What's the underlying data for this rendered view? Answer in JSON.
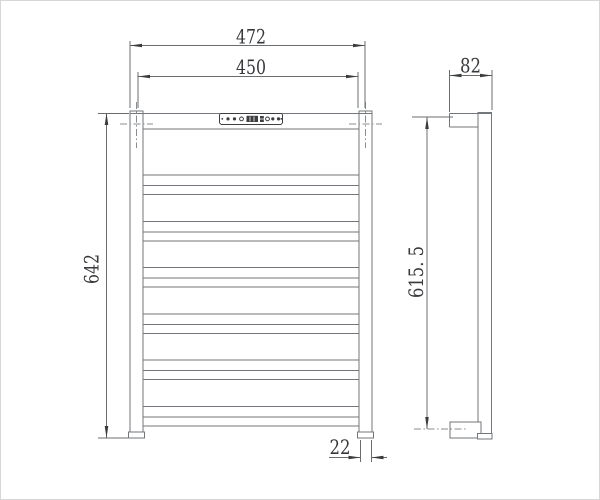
{
  "drawing": {
    "kind": "towel-rail-dimension-drawing",
    "background": "#ffffff",
    "frame_border_color": "#d6d6d6",
    "line_color": "#73767a",
    "dark_line_color": "#3c3e40",
    "dimension_line_color": "#6a6d70",
    "text_color": "#36383b",
    "front_view": {
      "rung_count": 6,
      "has_control_panel": true,
      "control_panel": {
        "round_button_count": 4,
        "ring_indicator_count": 2,
        "has_display_screen": true
      }
    },
    "side_view": {
      "has_top_arm": true,
      "has_bottom_bracket": true
    },
    "dimensions": {
      "overall_width": "472",
      "bar_width": "450",
      "overall_height": "642",
      "post_width": "22",
      "side_depth": "82",
      "side_height": "615. 5"
    }
  }
}
